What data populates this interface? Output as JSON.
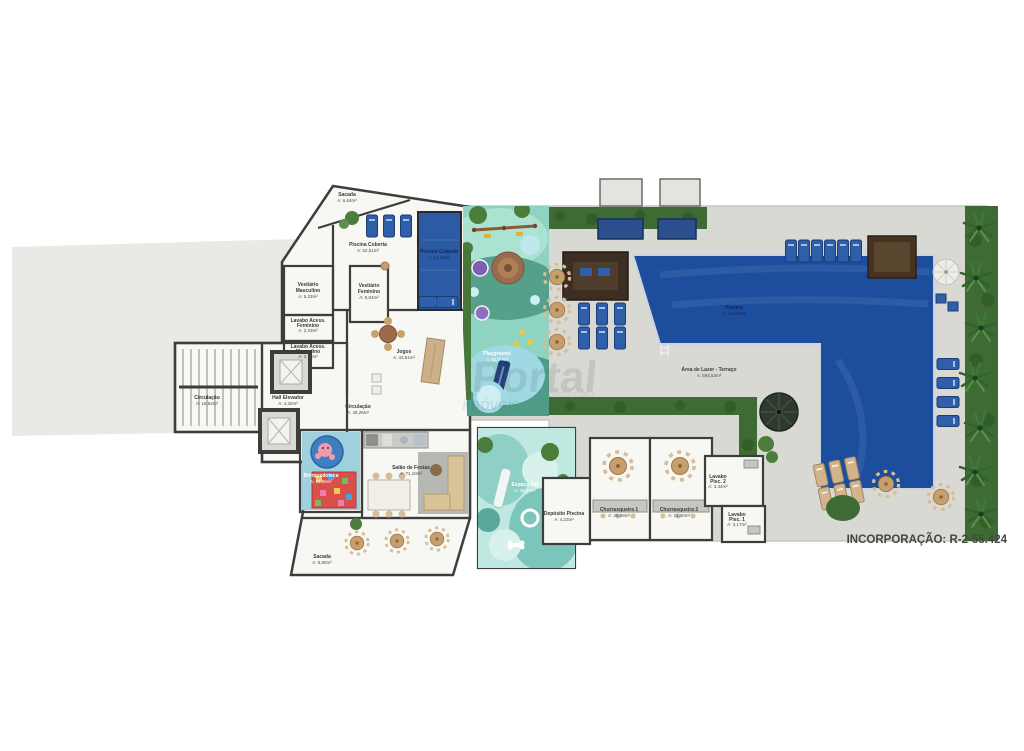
{
  "footer": {
    "incorporation": "INCORPORAÇÃO: R-2-55.424"
  },
  "watermark": {
    "line1": "Portal",
    "line2": "imóveis",
    "line3": "CRECI 5735-J"
  },
  "colors": {
    "left_area": "#e9e9e5",
    "terrace": "#d9d9d4",
    "floor": "#f7f7f4",
    "pool": "#1d4e9e",
    "indoor_pool": "#2b5ba6",
    "hedge": "#3e6b34",
    "playground_base": "#8fd3c2",
    "playground_dark": "#55a08b",
    "pet_base": "#bfe8e0",
    "wall": "#3d3d3b",
    "furniture_blue": "#2e5fa8",
    "furniture_beige": "#d2b48c"
  },
  "rooms": [
    {
      "n1": "Sacada",
      "n2": "",
      "a": "A: 6,64m²"
    },
    {
      "n1": "Piscina Coberta",
      "n2": "",
      "a": "A: 62,51m²"
    },
    {
      "n1": "Piscina Coberta",
      "n2": "",
      "a": "A: 13,15m²"
    },
    {
      "n1": "Vestiário",
      "n2": "Masculino",
      "a": "A: 5,23m²"
    },
    {
      "n1": "Vestiário",
      "n2": "Feminino",
      "a": "A: 5,04m²"
    },
    {
      "n1": "Lavabo Acess.",
      "n2": "Feminino",
      "a": "A: 2,23m²"
    },
    {
      "n1": "Lavabo Acess.",
      "n2": "Masculino",
      "a": "A: 2,18m²"
    },
    {
      "n1": "Circulação",
      "n2": "",
      "a": "A: 18,52m²"
    },
    {
      "n1": "Hall Elevador",
      "n2": "",
      "a": "A: 4,32m²"
    },
    {
      "n1": "Jogos",
      "n2": "",
      "a": "A: 43,51m²"
    },
    {
      "n1": "Circulação",
      "n2": "",
      "a": "A: 48,26m²"
    },
    {
      "n1": "Brinquedoteca",
      "n2": "",
      "a": "A: 15,55m²"
    },
    {
      "n1": "Salão de Festas",
      "n2": "",
      "a": "A: 71,10m²"
    },
    {
      "n1": "Sacada",
      "n2": "",
      "a": "A: 8,80m²"
    },
    {
      "n1": "Playground",
      "n2": "",
      "a": "A: 63,00m²"
    },
    {
      "n1": "Espaço Pet",
      "n2": "",
      "a": "A: 28,23m²"
    },
    {
      "n1": "Depósito Piscina",
      "n2": "",
      "a": "A: 4,23m²"
    },
    {
      "n1": "Churrasqueira 1",
      "n2": "",
      "a": "A: 26,98m²"
    },
    {
      "n1": "Churrasqueira 2",
      "n2": "",
      "a": "A: 21,00m²"
    },
    {
      "n1": "Lavabo",
      "n2": "Pisc. 2",
      "a": "A: 3,34m²"
    },
    {
      "n1": "Lavabo",
      "n2": "Pisc. 1",
      "a": "A: 3,17m²"
    },
    {
      "n1": "Piscina",
      "n2": "",
      "a": "A: 142,61m²"
    },
    {
      "n1": "Área de Lazer - Terraço",
      "n2": "",
      "a": "A: 584,53m²"
    }
  ]
}
